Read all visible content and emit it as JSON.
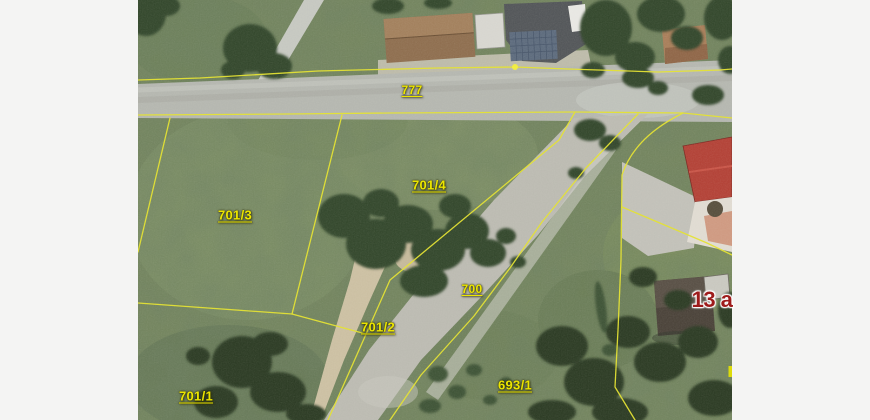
{
  "app": {
    "type": "cadastral-map-viewer",
    "view": "orthophoto-with-parcel-overlay"
  },
  "map": {
    "colors": {
      "canvas_margin": "#f4f4f3",
      "parcel_boundary": "#e4e135",
      "parcel_label": "#ece600",
      "house_number": "#9e1b1b"
    },
    "parcel_labels": [
      {
        "id": "777",
        "text": "777",
        "x": 412,
        "y": 90,
        "small": true
      },
      {
        "id": "701-4",
        "text": "701/4",
        "x": 429,
        "y": 185,
        "small": false
      },
      {
        "id": "701-3",
        "text": "701/3",
        "x": 235,
        "y": 215,
        "small": false
      },
      {
        "id": "700",
        "text": "700",
        "x": 472,
        "y": 289,
        "small": true
      },
      {
        "id": "701-2",
        "text": "701/2",
        "x": 378,
        "y": 327,
        "small": false
      },
      {
        "id": "693-1",
        "text": "693/1",
        "x": 515,
        "y": 385,
        "small": false
      },
      {
        "id": "701-1",
        "text": "701/1",
        "x": 196,
        "y": 396,
        "small": false
      }
    ],
    "house_numbers": [
      {
        "id": "13a",
        "text": "13 a",
        "x": 712,
        "y": 300
      }
    ]
  }
}
